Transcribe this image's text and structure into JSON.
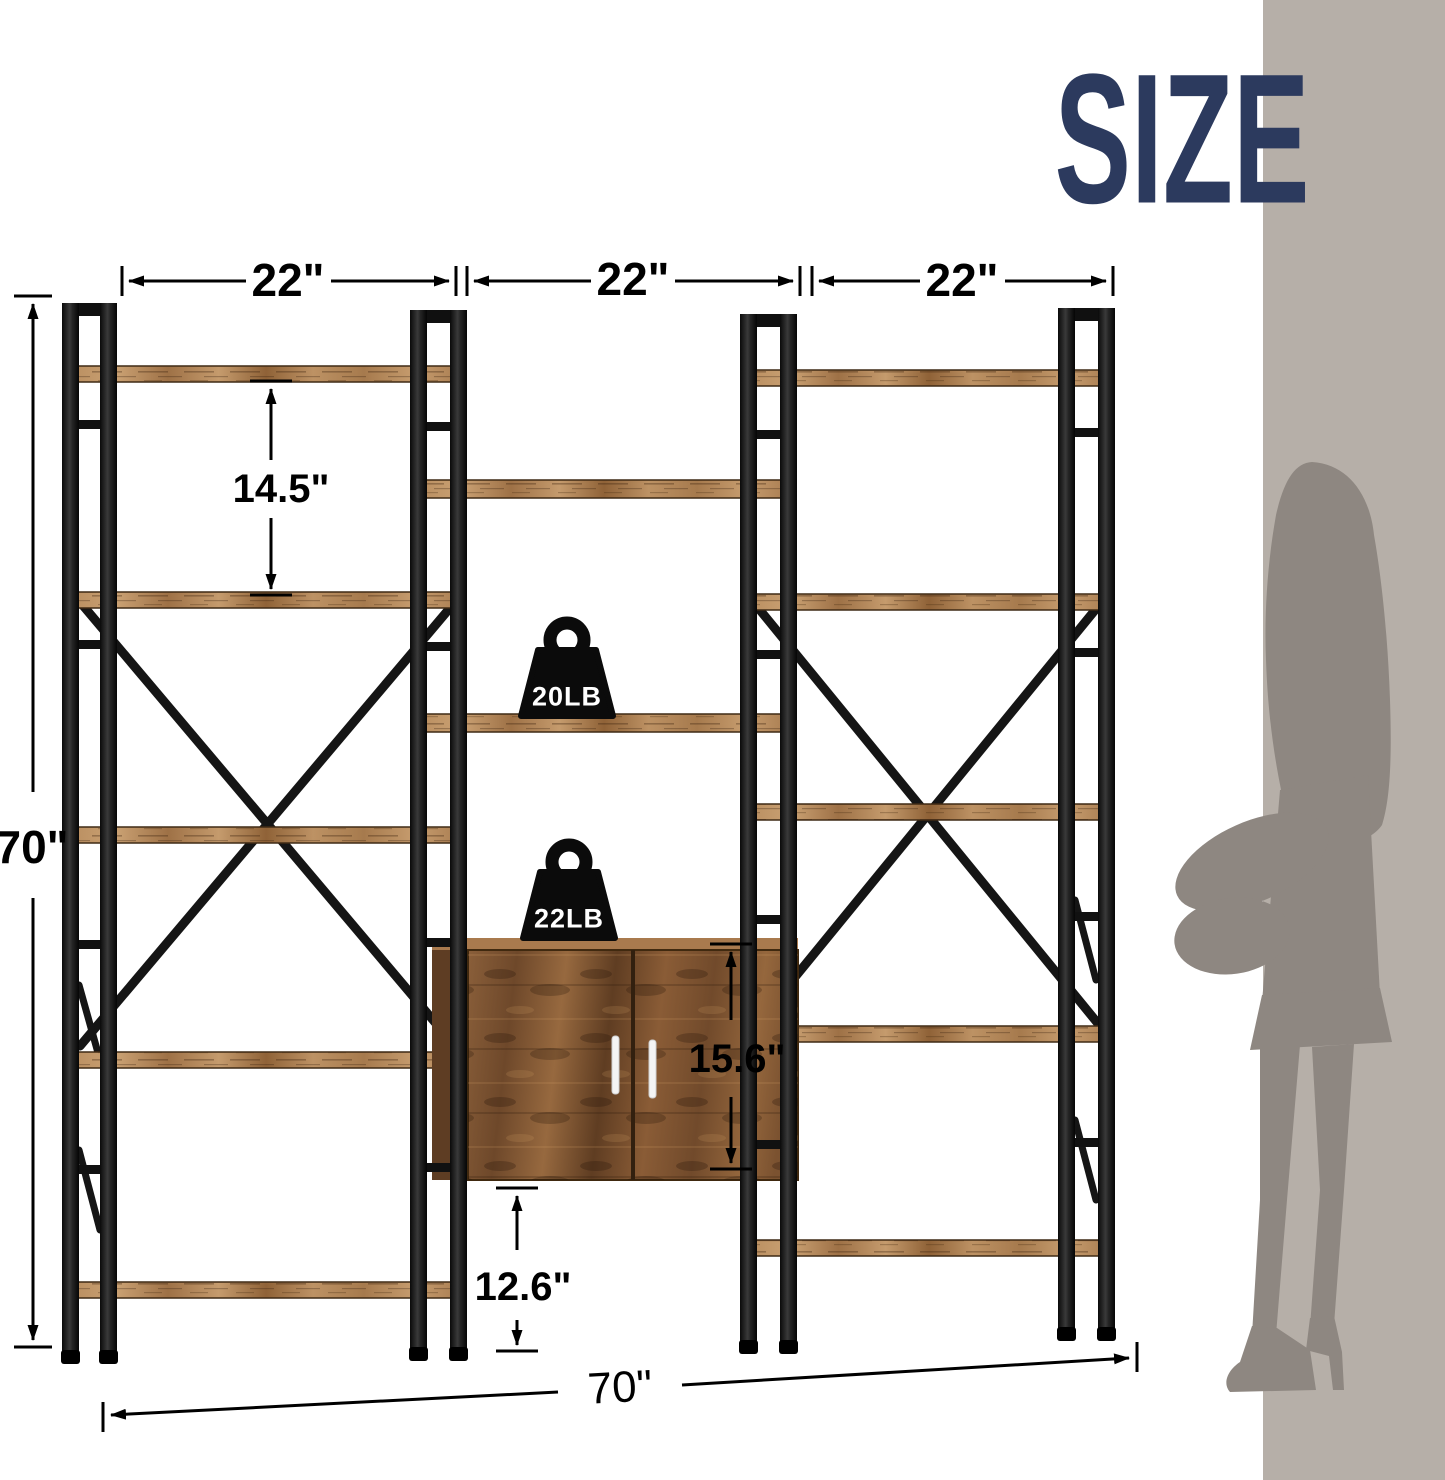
{
  "page": {
    "title": "SIZE"
  },
  "dimensions": {
    "section_width_left": "22\"",
    "section_width_middle": "22\"",
    "section_width_right": "22\"",
    "overall_height": "70\"",
    "shelf_spacing": "14.5\"",
    "cabinet_height": "15.6\"",
    "bottom_clearance": "12.6\"",
    "overall_width": "70\""
  },
  "load_capacity": {
    "open_shelf": "20LB",
    "cabinet_top": "22LB"
  },
  "colors": {
    "title_navy": "#2c3a5e",
    "wall_band_gray": "#b6afa8",
    "silhouette_gray": "#8e8781",
    "metal_black": "#141414",
    "wood_brown": "#9c7144",
    "cabinet_brown": "#7b5230",
    "annotation_black": "#000000",
    "background_white": "#ffffff"
  }
}
